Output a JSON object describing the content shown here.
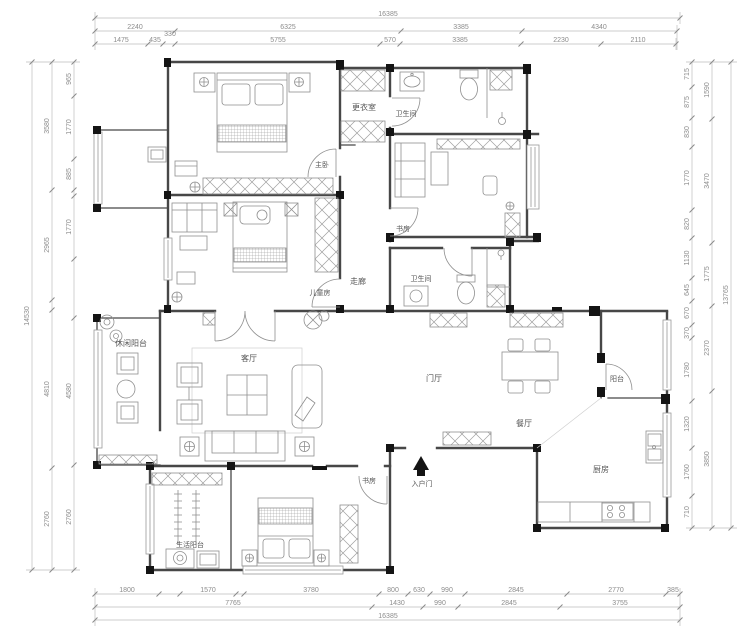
{
  "rooms": {
    "master": "主卧",
    "dressing": "更衣室",
    "bath1": "卫生间",
    "study_top": "书房",
    "corridor": "走廊",
    "kids": "儿童房",
    "bath2": "卫生间",
    "leisure_balcony": "休闲阳台",
    "living": "客厅",
    "foyer": "门厅",
    "balcony": "阳台",
    "dining": "餐厅",
    "kitchen": "厨房",
    "study_bottom": "书房",
    "laundry_balcony": "生活阳台",
    "entrance": "入户门"
  },
  "dims": {
    "top": {
      "total": "16385",
      "row2": [
        "2240",
        "6325",
        "3385",
        "4340"
      ],
      "row3": [
        "1475",
        "435",
        "330",
        "5755",
        "570",
        "3385",
        "2230",
        "2110"
      ]
    },
    "bottom": {
      "row1": [
        "1800",
        "1570",
        "3780",
        "800",
        "630",
        "990",
        "2845",
        "2770",
        "385"
      ],
      "row2": [
        "7765",
        "1430",
        "990",
        "2845",
        "3755"
      ],
      "total": "16385"
    },
    "left": {
      "outer": "14530",
      "mid": [
        "3580",
        "2965",
        "4810",
        "2760"
      ],
      "inner": [
        "965",
        "1770",
        "885",
        "1770",
        "4580",
        "2760"
      ]
    },
    "right": {
      "inner": [
        "715",
        "875",
        "830",
        "1770",
        "820",
        "1130",
        "645",
        "670",
        "370",
        "1780",
        "1320",
        "1760",
        "710"
      ],
      "mid": [
        "1590",
        "3470",
        "1775",
        "2370",
        "3850"
      ],
      "outer": "13765"
    }
  },
  "colors": {
    "wall": "#474747",
    "furniture": "#8f8f8f",
    "dimension": "#8c8c8c"
  }
}
